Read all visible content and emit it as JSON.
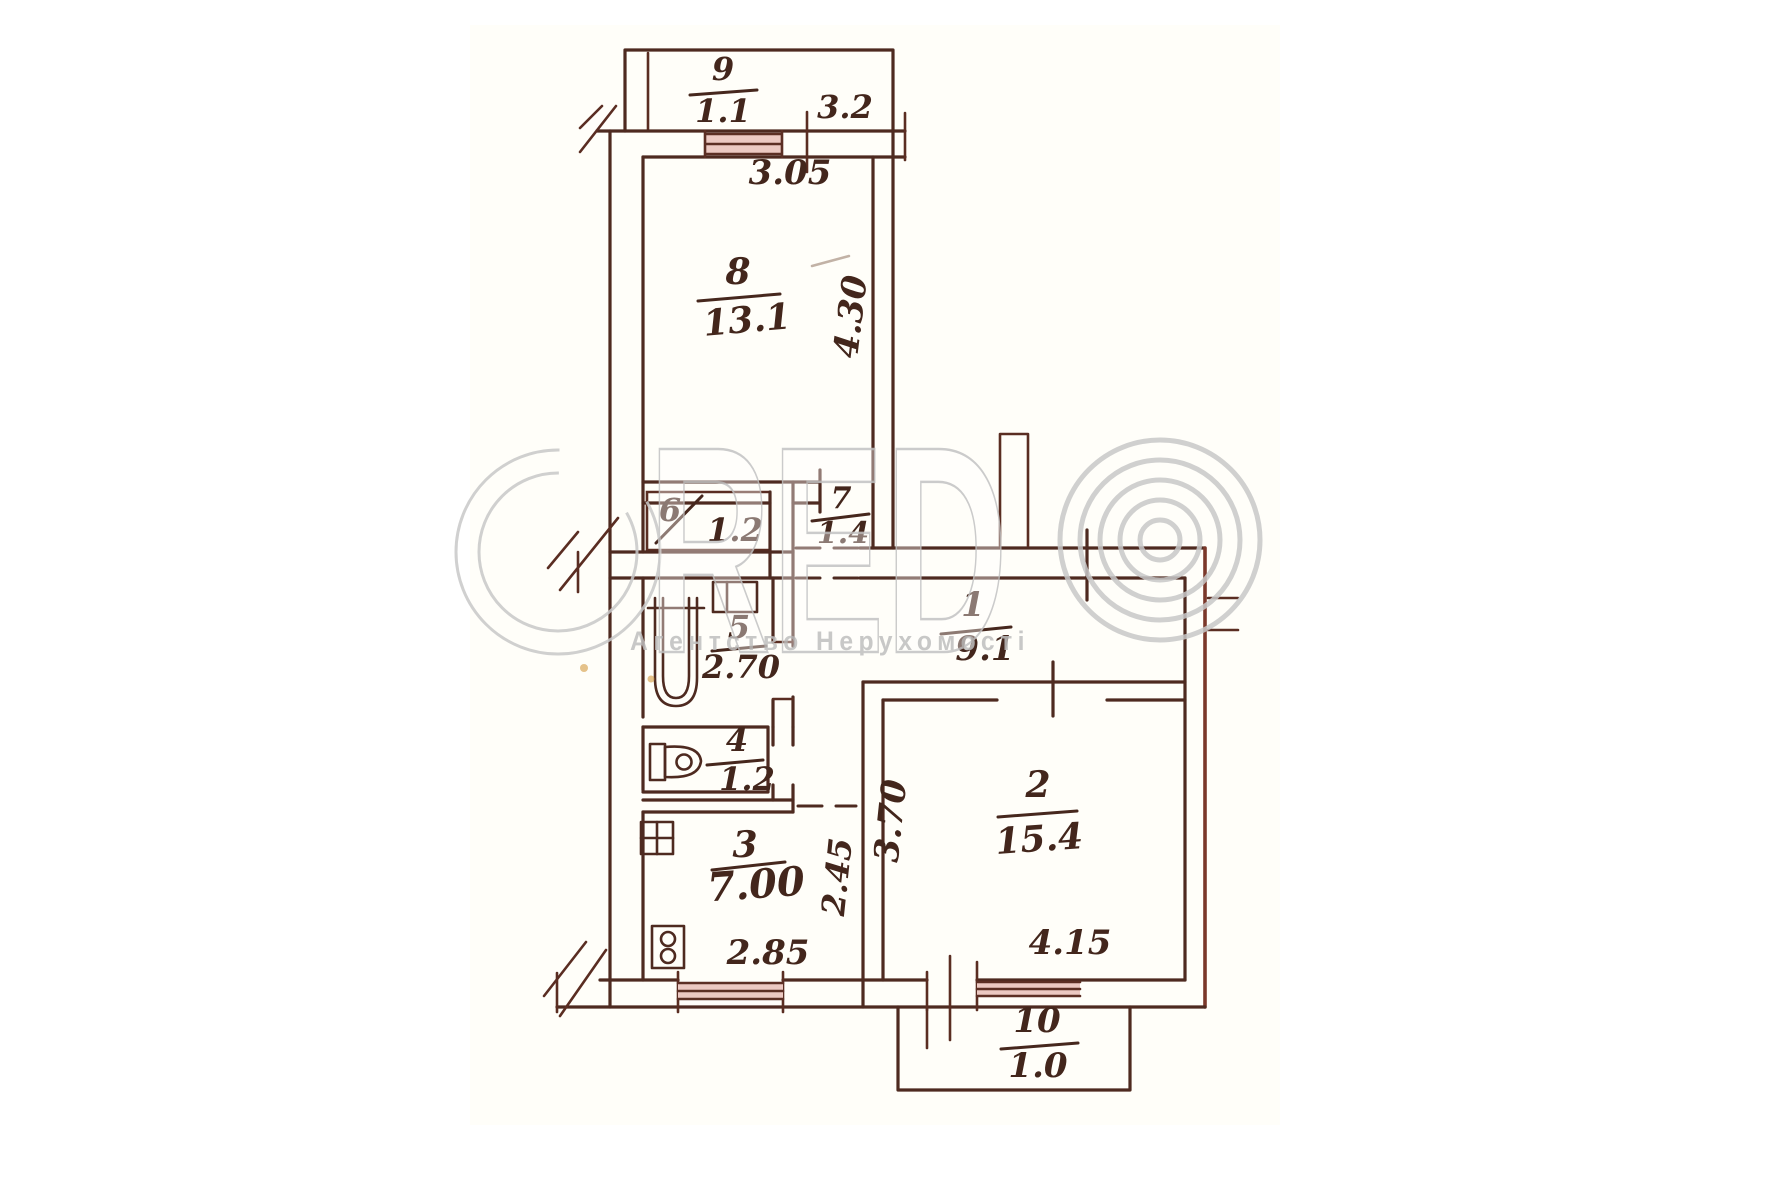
{
  "watermark": {
    "brand": "RED",
    "subtitle": "Агентство Нерухомості"
  },
  "rooms": {
    "r1": {
      "number": "1",
      "area": "9.1"
    },
    "r2": {
      "number": "2",
      "area": "15.4"
    },
    "r3": {
      "number": "3",
      "area": "7.00"
    },
    "r4": {
      "number": "4",
      "area": "1.2"
    },
    "r5": {
      "number": "5",
      "area": "2.70"
    },
    "r6": {
      "number": "6",
      "area": "1.2"
    },
    "r7": {
      "number": "7",
      "area": "1.4"
    },
    "r8": {
      "number": "8",
      "area": "13.1"
    },
    "r9": {
      "number": "9",
      "area": "1.1"
    },
    "r10": {
      "number": "10",
      "area": "1.0"
    }
  },
  "dimensions": {
    "balcony_offset": "3.2",
    "room8_width": "3.05",
    "room8_depth": "4.30",
    "kitchen_depth": "2.45",
    "kitchen_width": "2.85",
    "room2_depth": "3.70",
    "room2_width": "4.15"
  },
  "colors": {
    "ink": "#4e2a20",
    "window_fill": "#ecc9c2",
    "watermark_gray": "#c8c8c8",
    "paper": "#ffffff"
  }
}
